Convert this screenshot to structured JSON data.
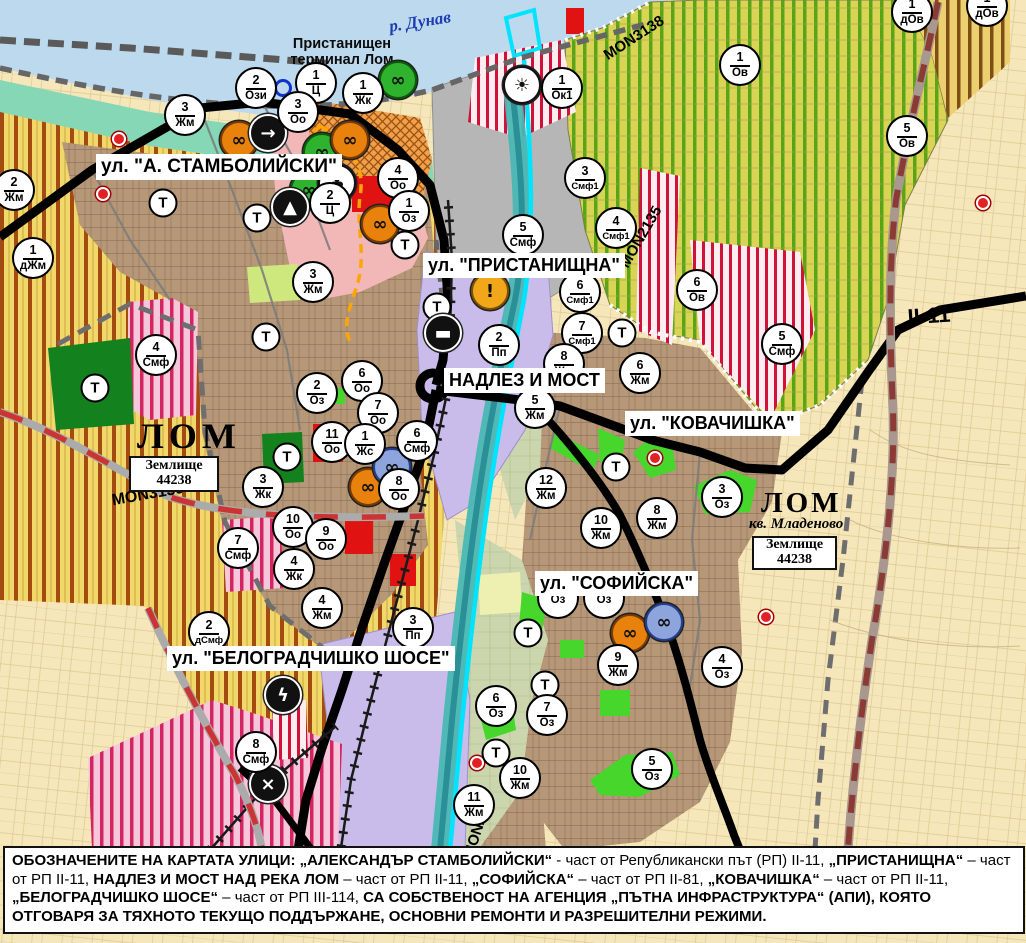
{
  "map": {
    "water_label": {
      "text": "р. Дунав"
    },
    "port_label": {
      "text": "Пристанищен\nтерминал Лом"
    },
    "place_labels": {
      "lom_left": "ЛОМ",
      "lom_right": "ЛОМ",
      "kv_mladenovo": "кв. Младеново"
    },
    "zemlishte": {
      "line1": "Землище",
      "line2": "44238"
    },
    "t_label": "Т",
    "street_labels": [
      {
        "id": "stamboliyski",
        "text": "ул. \"А. СТАМБОЛИЙСКИ\"",
        "x": 96,
        "y": 154,
        "fs": 19
      },
      {
        "id": "pristanishtna",
        "text": "ул. \"ПРИСТАНИЩНА\"",
        "x": 423,
        "y": 253,
        "fs": 18
      },
      {
        "id": "nadlez-i-most",
        "text": "НАДЛЕЗ И МОСТ",
        "x": 444,
        "y": 368,
        "fs": 18
      },
      {
        "id": "kovachishka",
        "text": "ул. \"КОВАЧИШКА\"",
        "x": 625,
        "y": 411,
        "fs": 18
      },
      {
        "id": "sofiyska",
        "text": "ул. \"СОФИЙСКА\"",
        "x": 535,
        "y": 571,
        "fs": 18
      },
      {
        "id": "belogradchishko",
        "text": "ул. \"БЕЛОГРАДЧИШКО ШОСЕ\"",
        "x": 167,
        "y": 646,
        "fs": 18
      }
    ],
    "road_labels": [
      {
        "id": "mon3138",
        "text": "MON3138",
        "x": 634,
        "y": 38,
        "rot": -33,
        "fs": 15
      },
      {
        "id": "mon2135",
        "text": "MON2135",
        "x": 641,
        "y": 237,
        "rot": -60,
        "fs": 15
      },
      {
        "id": "mon3139",
        "text": "MON3139",
        "x": 148,
        "y": 495,
        "rot": -10,
        "fs": 16
      },
      {
        "id": "mon2136",
        "text": "MON2136",
        "x": 479,
        "y": 825,
        "rot": -72,
        "fs": 15
      },
      {
        "id": "ii-11",
        "text": "II-11",
        "x": 929,
        "y": 316,
        "rot": -4,
        "fs": 22
      }
    ],
    "markers": [
      {
        "n": "2",
        "c": "Ози",
        "x": 256,
        "y": 88
      },
      {
        "n": "1",
        "c": "Ц",
        "x": 316,
        "y": 83
      },
      {
        "n": "1",
        "c": "Жк",
        "x": 363,
        "y": 93
      },
      {
        "n": "3",
        "c": "Оо",
        "x": 298,
        "y": 112
      },
      {
        "n": "1",
        "c": "Ок1",
        "x": 562,
        "y": 88
      },
      {
        "n": "3",
        "c": "Жм",
        "x": 185,
        "y": 115
      },
      {
        "n": "2",
        "c": "Жм",
        "x": 14,
        "y": 190
      },
      {
        "n": "1",
        "c": "дЖм",
        "x": 33,
        "y": 258
      },
      {
        "n": "3",
        "c": "Жм",
        "x": 313,
        "y": 282
      },
      {
        "n": "4",
        "c": "Оо",
        "x": 398,
        "y": 178
      },
      {
        "n": "2",
        "c": "Ц",
        "x": 330,
        "y": 203
      },
      {
        "n": "1",
        "c": "Оз",
        "x": 409,
        "y": 211
      },
      {
        "n": "5",
        "c": "Смф",
        "x": 523,
        "y": 235
      },
      {
        "n": "3",
        "c": "Смф1",
        "x": 585,
        "y": 178
      },
      {
        "n": "4",
        "c": "Смф1",
        "x": 616,
        "y": 228
      },
      {
        "n": "6",
        "c": "Смф1",
        "x": 580,
        "y": 292
      },
      {
        "n": "7",
        "c": "Смф1",
        "x": 582,
        "y": 333
      },
      {
        "n": "6",
        "c": "Ов",
        "x": 697,
        "y": 290
      },
      {
        "n": "1",
        "c": "Ов",
        "x": 740,
        "y": 65
      },
      {
        "n": "5",
        "c": "Ов",
        "x": 907,
        "y": 136
      },
      {
        "n": "1",
        "c": "дОв",
        "x": 912,
        "y": 12
      },
      {
        "n": "1",
        "c": "дОв",
        "x": 987,
        "y": 6
      },
      {
        "n": "6",
        "c": "Жм",
        "x": 640,
        "y": 373
      },
      {
        "n": "2",
        "c": "Пп",
        "x": 499,
        "y": 345
      },
      {
        "n": "8",
        "c": "Жм",
        "x": 564,
        "y": 364
      },
      {
        "n": "5",
        "c": "Жм",
        "x": 535,
        "y": 408
      },
      {
        "n": "12",
        "c": "Жм",
        "x": 546,
        "y": 488
      },
      {
        "n": "10",
        "c": "Жм",
        "x": 601,
        "y": 528
      },
      {
        "n": "8",
        "c": "Жм",
        "x": 657,
        "y": 518
      },
      {
        "n": "3",
        "c": "Оз",
        "x": 722,
        "y": 497
      },
      {
        "n": "5",
        "c": "Смф",
        "x": 782,
        "y": 344
      },
      {
        "n": "4",
        "c": "Смф",
        "x": 156,
        "y": 355
      },
      {
        "n": "2",
        "c": "Оз",
        "x": 317,
        "y": 393
      },
      {
        "n": "6",
        "c": "Оо",
        "x": 362,
        "y": 381
      },
      {
        "n": "7",
        "c": "Оо",
        "x": 378,
        "y": 413
      },
      {
        "n": "11",
        "c": "Оо",
        "x": 332,
        "y": 442
      },
      {
        "n": "1",
        "c": "Жс",
        "x": 365,
        "y": 444
      },
      {
        "n": "6",
        "c": "Смф",
        "x": 417,
        "y": 441
      },
      {
        "n": "8",
        "c": "Оо",
        "x": 399,
        "y": 489
      },
      {
        "n": "3",
        "c": "Жк",
        "x": 263,
        "y": 487
      },
      {
        "n": "10",
        "c": "Оо",
        "x": 293,
        "y": 527
      },
      {
        "n": "9",
        "c": "Оо",
        "x": 326,
        "y": 539
      },
      {
        "n": "7",
        "c": "Смф",
        "x": 238,
        "y": 548
      },
      {
        "n": "4",
        "c": "Жк",
        "x": 294,
        "y": 569
      },
      {
        "n": "4",
        "c": "Жм",
        "x": 322,
        "y": 608
      },
      {
        "n": "2",
        "c": "дСмф",
        "x": 209,
        "y": 632
      },
      {
        "n": "3",
        "c": "Пп",
        "x": 413,
        "y": 628
      },
      {
        "n": "8",
        "c": "Смф",
        "x": 256,
        "y": 752
      },
      {
        "n": "9",
        "c": "Жм",
        "x": 618,
        "y": 665
      },
      {
        "n": "4",
        "c": "Оз",
        "x": 722,
        "y": 667
      },
      {
        "n": "6",
        "c": "Оз",
        "x": 496,
        "y": 706
      },
      {
        "n": "7",
        "c": "Оз",
        "x": 547,
        "y": 715
      },
      {
        "n": "5",
        "c": "Оз",
        "x": 652,
        "y": 769
      },
      {
        "n": "10",
        "c": "Жм",
        "x": 520,
        "y": 778
      },
      {
        "n": "11",
        "c": "Жм",
        "x": 474,
        "y": 805
      },
      {
        "n": "",
        "c": "Оз",
        "x": 558,
        "y": 598
      },
      {
        "n": "",
        "c": "Оз",
        "x": 604,
        "y": 598
      }
    ],
    "t_markers": [
      [
        163,
        203
      ],
      [
        257,
        218
      ],
      [
        266,
        337
      ],
      [
        405,
        245
      ],
      [
        437,
        307
      ],
      [
        95,
        388
      ],
      [
        287,
        457
      ],
      [
        622,
        333
      ],
      [
        616,
        467
      ],
      [
        528,
        633
      ],
      [
        545,
        685
      ],
      [
        496,
        753
      ]
    ],
    "icons": [
      {
        "t": "monument-green",
        "x": 398,
        "y": 80
      },
      {
        "t": "monument-green",
        "x": 322,
        "y": 152
      },
      {
        "t": "monument-green",
        "x": 309,
        "y": 190
      },
      {
        "t": "monument-orange",
        "x": 239,
        "y": 140
      },
      {
        "t": "monument-orange",
        "x": 350,
        "y": 140
      },
      {
        "t": "monument-orange",
        "x": 380,
        "y": 224
      },
      {
        "t": "monument-orange",
        "x": 368,
        "y": 487
      },
      {
        "t": "monument-orange",
        "x": 630,
        "y": 633
      },
      {
        "t": "monument-blue",
        "x": 392,
        "y": 467
      },
      {
        "t": "monument-blue",
        "x": 664,
        "y": 622
      },
      {
        "t": "arrow",
        "x": 268,
        "y": 133
      },
      {
        "t": "people",
        "x": 337,
        "y": 183
      },
      {
        "t": "tunnel",
        "x": 290,
        "y": 207
      },
      {
        "t": "sun",
        "x": 522,
        "y": 85
      },
      {
        "t": "excl",
        "x": 490,
        "y": 291
      },
      {
        "t": "truck",
        "x": 443,
        "y": 333
      },
      {
        "t": "bolt",
        "x": 283,
        "y": 695
      },
      {
        "t": "railcross",
        "x": 268,
        "y": 784
      },
      {
        "t": "bluering",
        "x": 283,
        "y": 88
      }
    ],
    "icon_styles": {
      "monument-green": {
        "bg": "#2fb32f",
        "fg": "#111111",
        "bd": "#0b5d0b"
      },
      "monument-orange": {
        "bg": "#e8820c",
        "fg": "#111111",
        "bd": "#7a3c00"
      },
      "monument-blue": {
        "bg": "#8da4dc",
        "fg": "#111111",
        "bd": "#23408f"
      },
      "arrow": {
        "bg": "#111111",
        "fg": "#ffffff",
        "bd": "#ffffff"
      },
      "people": {
        "bg": "#ffffff",
        "fg": "#111111",
        "bd": "#111111"
      },
      "tunnel": {
        "bg": "#111111",
        "fg": "#ffffff",
        "bd": "#ffffff"
      },
      "sun": {
        "bg": "#ffffff",
        "fg": "#111111",
        "bd": "#111111"
      },
      "excl": {
        "bg": "#f2a71b",
        "fg": "#111111",
        "bd": "#7a5200"
      },
      "truck": {
        "bg": "#111111",
        "fg": "#ffffff",
        "bd": "#ffffff"
      },
      "bolt": {
        "bg": "#111111",
        "fg": "#ffffff",
        "bd": "#ffffff"
      },
      "railcross": {
        "bg": "#111111",
        "fg": "#ffffff",
        "bd": "#ffffff"
      },
      "bluering": {
        "bg": "transparent",
        "fg": "#1133cc",
        "bd": "#1133cc"
      }
    },
    "dots": [
      [
        119,
        139
      ],
      [
        103,
        194
      ],
      [
        655,
        458
      ],
      [
        477,
        763
      ],
      [
        983,
        203
      ],
      [
        766,
        617
      ]
    ],
    "colors": {
      "water": "#bcd9ee",
      "coast": "#86d7b5",
      "port_gray": "#b7b6b6",
      "farmland": "#f2d76b",
      "farmland_stripe": "#a34b10",
      "vineyard": "#d9d456",
      "vineyard_stripe": "#5aa417",
      "urban": "#b69878",
      "cream": "#f6e7ba",
      "lavender": "#cabcea",
      "red_stripe": "#d01238",
      "pink_stripe": "#d42560",
      "park_green": "#13811d",
      "bright_green": "#46d62c",
      "orange_zone": "#efa04a",
      "road_black": "#000000",
      "bypass_red": "#cc3333",
      "river": "#49b8b4",
      "channel_cyan": "#00e4ff"
    },
    "note": {
      "segments": [
        {
          "t": "ОБОЗНАЧЕНИТЕ НА КАРТАТА УЛИЦИ: „АЛЕКСАНДЪР СТАМБОЛИЙСКИ“",
          "b": true
        },
        {
          "t": " - част от Републикански път (РП) II-11, ",
          "b": false
        },
        {
          "t": "„ПРИСТАНИЩНА“",
          "b": true
        },
        {
          "t": " – част от РП II-11, ",
          "b": false
        },
        {
          "t": "НАДЛЕЗ И МОСТ НАД РЕКА ЛОМ",
          "b": true
        },
        {
          "t": " – част от РП II-11, ",
          "b": false
        },
        {
          "t": "„СОФИЙСКА“",
          "b": true
        },
        {
          "t": " – част от РП II-81, ",
          "b": false
        },
        {
          "t": "„КОВАЧИШКА“",
          "b": true
        },
        {
          "t": " – част от РП II-11, ",
          "b": false
        },
        {
          "t": "„БЕЛОГРАДЧИШКО ШОСЕ“",
          "b": true
        },
        {
          "t": " – част от РП III-114, ",
          "b": false
        },
        {
          "t": "СА СОБСТВЕНОСТ НА АГЕНЦИЯ „ПЪТНА ИНФРАСТРУКТУРА“ (АПИ), КОЯТО ОТГОВАРЯ ЗА ТЯХНОТО ТЕКУЩО ПОДДЪРЖАНЕ, ОСНОВНИ РЕМОНТИ И РАЗРЕШИТЕЛНИ РЕЖИМИ.",
          "b": true
        }
      ]
    }
  }
}
